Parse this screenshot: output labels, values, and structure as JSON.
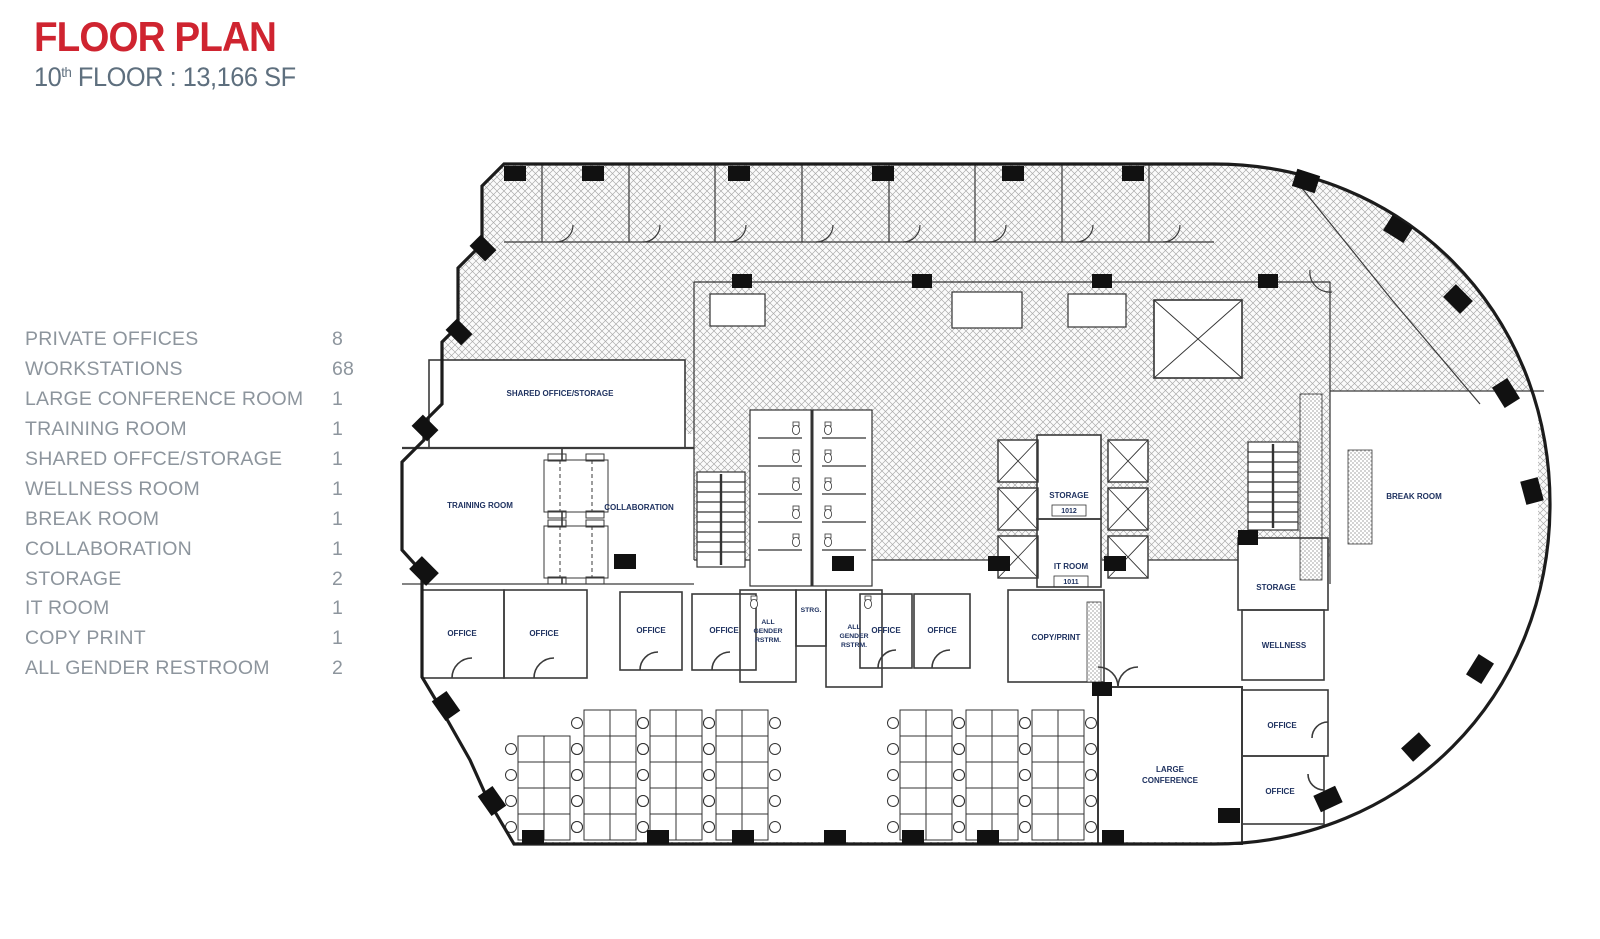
{
  "header": {
    "title": "FLOOR PLAN",
    "floor_number": "10",
    "floor_ordinal": "th",
    "floor_suffix": " FLOOR : 13,166 SF"
  },
  "legend": {
    "items": [
      {
        "label": "PRIVATE OFFICES",
        "count": "8"
      },
      {
        "label": "WORKSTATIONS",
        "count": "68"
      },
      {
        "label": "LARGE CONFERENCE ROOM",
        "count": "1"
      },
      {
        "label": "TRAINING ROOM",
        "count": "1"
      },
      {
        "label": "SHARED OFFCE/STORAGE",
        "count": "1"
      },
      {
        "label": "WELLNESS ROOM",
        "count": "1"
      },
      {
        "label": "BREAK ROOM",
        "count": "1"
      },
      {
        "label": "COLLABORATION",
        "count": "1"
      },
      {
        "label": "STORAGE",
        "count": "2"
      },
      {
        "label": "IT ROOM",
        "count": "1"
      },
      {
        "label": "COPY PRINT",
        "count": "1"
      },
      {
        "label": "ALL GENDER RESTROOM",
        "count": "2"
      }
    ]
  },
  "plan": {
    "labels": {
      "shared": "SHARED OFFICE/STORAGE",
      "training": "TRAINING ROOM",
      "collaboration": "COLLABORATION",
      "office": "OFFICE",
      "all_gender": [
        "ALL",
        "GENDER",
        "RSTRM."
      ],
      "strg": "STRG.",
      "copy_print": "COPY/PRINT",
      "storage": "STORAGE",
      "storage_tag": "1012",
      "it_room": "IT ROOM",
      "it_room_tag": "1011",
      "wellness": "WELLNESS",
      "break_room": "BREAK ROOM",
      "large_conference": [
        "LARGE",
        "CONFERENCE"
      ]
    },
    "colors": {
      "accent_red": "#cf2430",
      "subtitle_gray": "#5e6f7e",
      "legend_gray": "#8d959d",
      "label_blue": "#1f3260",
      "wall_black": "#1c1c1c"
    }
  }
}
